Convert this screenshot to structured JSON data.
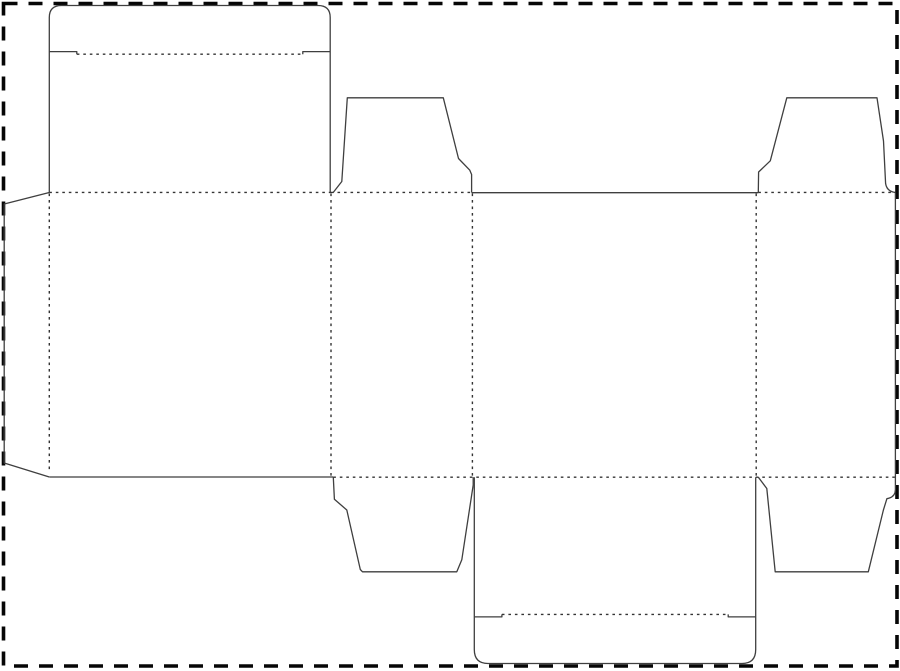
{
  "page": {
    "width": 900,
    "height": 671,
    "background_color": "#ffffff"
  },
  "sheet_border": {
    "x": 3.5,
    "y": 3.5,
    "width": 893.5,
    "height": 662.5,
    "color": "#060606",
    "thickness": 3.6,
    "dash_pattern": "14 11"
  },
  "dieline": {
    "cut_color": "#3f3f3f",
    "cut_width": 1.3,
    "fold_color": "#343434",
    "fold_width": 1.4,
    "fold_dash": "2.6 3.9",
    "cut_paths": [
      {
        "name": "glue-flap-outline",
        "d": "M 49.3 192.5 L 4.2 204 L 4.2 463 L 49.3 477"
      },
      {
        "name": "top-tuck-lid-outline",
        "d": "M 49.3 192.5 L 49.3 17.5 Q 49.3 5.5 61.5 5.5 L 318 5.5 Q 330.2 5.5 330.2 17.5 L 330.2 192.5"
      },
      {
        "name": "top-lid-slit-left",
        "d": "M 49.3 51.6 L 76.8 51.6 L 76.8 54.2"
      },
      {
        "name": "top-lid-slit-right",
        "d": "M 330.2 51.6 L 302.8 51.6 L 302.8 54.2"
      },
      {
        "name": "dust-flap-top-left-outline",
        "d": "M 333.2 192.5 L 341.8 181.5 L 347.3 97.8 L 443.3 97.8 L 458.5 158.5 L 469.8 170.2 L 471.6 174.5 L 471.6 192.5"
      },
      {
        "name": "front-panel-top-cut-edge",
        "d": "M 471.6 192.7 L 758.3 192.7"
      },
      {
        "name": "dust-flap-top-right-outline",
        "d": "M 758.3 192.5 L 758.6 172 L 770.3 160.8 L 786.8 97.8 L 877 97.8 L 883.5 141 L 885.6 183.5 Q 886.8 191.5 895.4 192.5"
      },
      {
        "name": "right-edge-and-dust-flap-bottom-right-outline",
        "d": "M 895.4 192.5 L 895.4 489.5 Q 895.4 497.2 886.9 498.7 L 883.4 510 L 868.3 571.8 L 775.2 571.8 L 766.8 488.5 L 758.3 477.2"
      },
      {
        "name": "dust-flap-bottom-left-outline",
        "d": "M 333.3 477.2 L 334.4 499.3 L 346.8 510 L 360.3 569.5 L 362.5 571.8 L 456.8 571.8 L 461.8 559.8 L 473.2 485 L 473.2 477.2"
      },
      {
        "name": "back-panel-bottom-cut-edge",
        "d": "M 49.3 477 L 333.3 477"
      },
      {
        "name": "bottom-tuck-lid-outline",
        "d": "M 474.3 477.2 L 474.3 649.5 Q 474.3 663.5 488 663.5 L 742 663.5 Q 755.7 663.5 755.7 649.5 L 755.7 477.2"
      },
      {
        "name": "bottom-lid-slit-left",
        "d": "M 474.3 616.9 L 501.9 616.9 L 501.9 614.4"
      },
      {
        "name": "bottom-lid-slit-right",
        "d": "M 755.7 616.9 L 728.2 616.9 L 728.2 614.4"
      }
    ],
    "fold_lines": [
      {
        "name": "fold-top-back-panel-lid",
        "x1": 49.3,
        "y1": 192.4,
        "x2": 331.0,
        "y2": 192.4
      },
      {
        "name": "fold-top-dust-flap-left",
        "x1": 331.0,
        "y1": 192.4,
        "x2": 471.6,
        "y2": 192.4
      },
      {
        "name": "fold-top-dust-flap-right",
        "x1": 758.3,
        "y1": 192.4,
        "x2": 895.4,
        "y2": 192.4
      },
      {
        "name": "fold-bottom-flaps",
        "x1": 333.3,
        "y1": 477.2,
        "x2": 895.4,
        "y2": 477.2
      },
      {
        "name": "fold-glue-flap",
        "x1": 49.3,
        "y1": 193.5,
        "x2": 49.3,
        "y2": 471.5
      },
      {
        "name": "fold-back-panel-side-panel-left",
        "x1": 331.0,
        "y1": 193.5,
        "x2": 331.0,
        "y2": 476.0
      },
      {
        "name": "fold-side-panel-left-front-panel",
        "x1": 472.4,
        "y1": 193.5,
        "x2": 472.4,
        "y2": 476.0
      },
      {
        "name": "fold-front-panel-side-panel-right",
        "x1": 756.2,
        "y1": 193.5,
        "x2": 756.2,
        "y2": 476.0
      },
      {
        "name": "crease-top-tuck-flap",
        "x1": 76.8,
        "y1": 54.2,
        "x2": 302.8,
        "y2": 54.2
      },
      {
        "name": "crease-bottom-tuck-flap",
        "x1": 501.9,
        "y1": 614.4,
        "x2": 728.2,
        "y2": 614.4
      }
    ]
  }
}
